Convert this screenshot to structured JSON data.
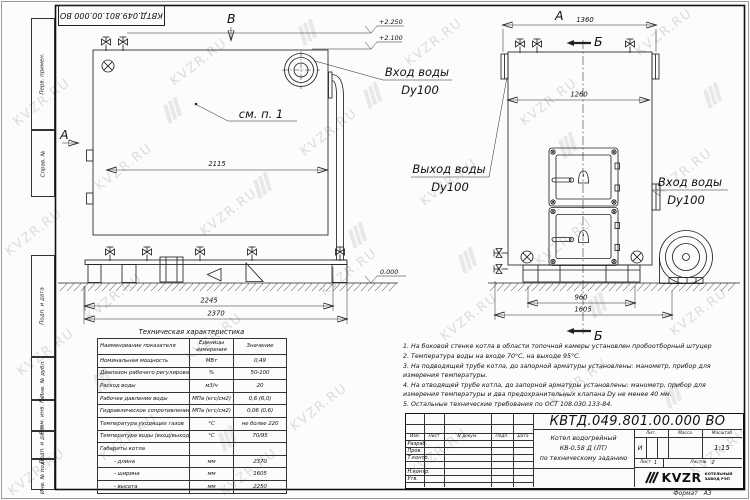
{
  "sheet": {
    "watermark": "KVZR.RU",
    "doc_number": "КВТД.049.801.00.000 ВО",
    "format_label": "Формат",
    "format_value": "А3"
  },
  "margin_stamps": {
    "items": [
      "Перв. примен.",
      "Справ. №",
      "Подп. и дата",
      "Инв. № дубл.",
      "Взам. инв. №",
      "Подп. и дата",
      "Инв. № подл."
    ]
  },
  "drawing": {
    "view_a": "А",
    "view_b": "В",
    "section_b": "Б",
    "see_note": "см. п. 1",
    "elev_top": "+2.250",
    "elev_mid": "+2.100",
    "elev_zero": "0.000",
    "inlet_label": "Вход воды",
    "inlet_size": "Dy100",
    "outlet_label": "Выход воды",
    "outlet_size": "Dy100",
    "dims": {
      "front_inner": "2115",
      "front_mid": "2245",
      "front_outer": "2370",
      "side_top": "1360",
      "side_inner": "1260",
      "side_base": "960",
      "side_skid": "1605"
    }
  },
  "spec_table": {
    "title": "Техническая характеристика",
    "headers": [
      "Наименование показателя",
      "Еденицы измерения",
      "Значение"
    ],
    "rows": [
      [
        "Номинальная мощность",
        "МВт",
        "0,49"
      ],
      [
        "Диапазон рабочего регулирования",
        "%",
        "50-100"
      ],
      [
        "Расход воды",
        "м3/ч",
        "20"
      ],
      [
        "Рабочее давление воды",
        "МПа (кгс/см2)",
        "0,6 (6,0)"
      ],
      [
        "Гидравлическое сопротивление котла",
        "МПа (кгс/см2)",
        "0,06 (0,6)"
      ],
      [
        "Температура уходящих газов",
        "°С",
        "не более 220"
      ],
      [
        "Температура воды (вход/выход)",
        "°С",
        "70/95"
      ],
      [
        "Габариты котла",
        "",
        ""
      ],
      [
        "- длина",
        "мм",
        "2370"
      ],
      [
        "- ширина",
        "мм",
        "1605"
      ],
      [
        "- высота",
        "мм",
        "2250"
      ]
    ]
  },
  "notes": [
    "1. На боковой стенке котла в области топочной камеры установлен пробоотборный штуцер",
    "2. Температура воды на входе 70°С, на выходе 95°С.",
    "3. На подводящей трубе котла, до запорной арматуры установлены: манометр, прибор для измерения температуры.",
    "4. На отводящей трубе котла, до запорной арматуры установлены: манометр, прибор для измерения температуры и два предохранительных клапана Dу не менее 40 мм.",
    "5. Остальные технические требования по ОСТ 108.030.133-84."
  ],
  "title_block": {
    "doc_number": "КВТД.049.801.00.000 ВО",
    "name_line1": "Котел водогрейный",
    "name_line2": "КВ-0,58 Д (ЛТ)",
    "name_line3": "по техническому заданию",
    "col_izm": "Изм.",
    "col_list": "Лист",
    "col_doc": "N докум.",
    "col_sign": "Подп.",
    "col_date": "Дата",
    "row_developed": "Разраб.",
    "row_checked": "Пров.",
    "row_tcontrol": "Т.контр.",
    "row_ncontrol": "Н.контр.",
    "row_approved": "Утв.",
    "lit_label": "Лит.",
    "lit_value": "И",
    "mass_label": "Масса",
    "scale_label": "Масштаб",
    "scale_value": "1:15",
    "sheet_label": "Лист",
    "sheet_value": "1",
    "sheets_label": "Листов",
    "sheets_value": "2",
    "logo_text": "KVZR",
    "company_line1": "КОТЕЛЬНЫЙ",
    "company_line2": "ЗАВОД РЭП"
  }
}
